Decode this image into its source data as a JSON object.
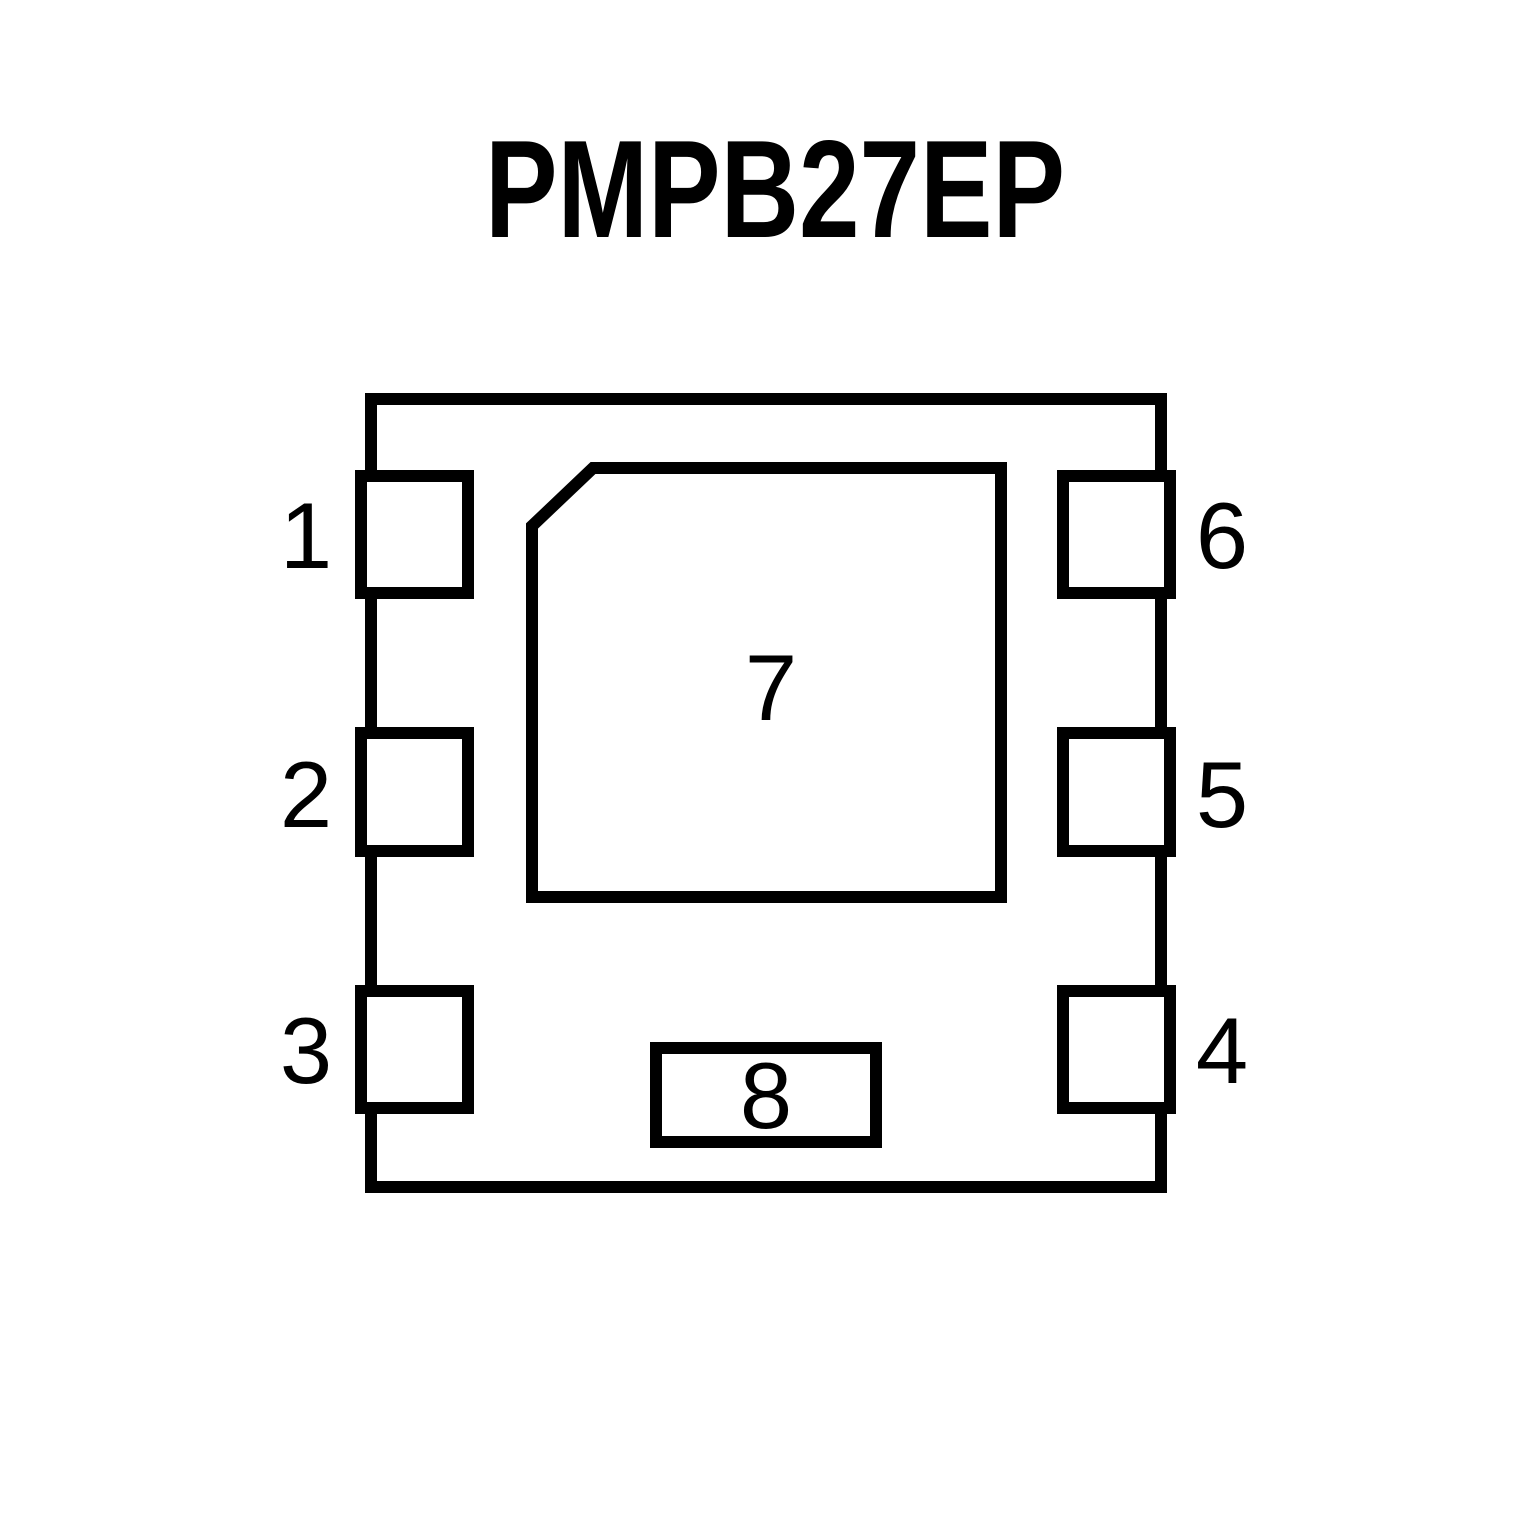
{
  "title": "PMPB27EP",
  "colors": {
    "ink": "#000000",
    "background": "#ffffff"
  },
  "pinout": {
    "left_pins": [
      "1",
      "2",
      "3"
    ],
    "right_pins": [
      "6",
      "5",
      "4"
    ],
    "center_pad": "7",
    "bottom_pad": "8"
  }
}
